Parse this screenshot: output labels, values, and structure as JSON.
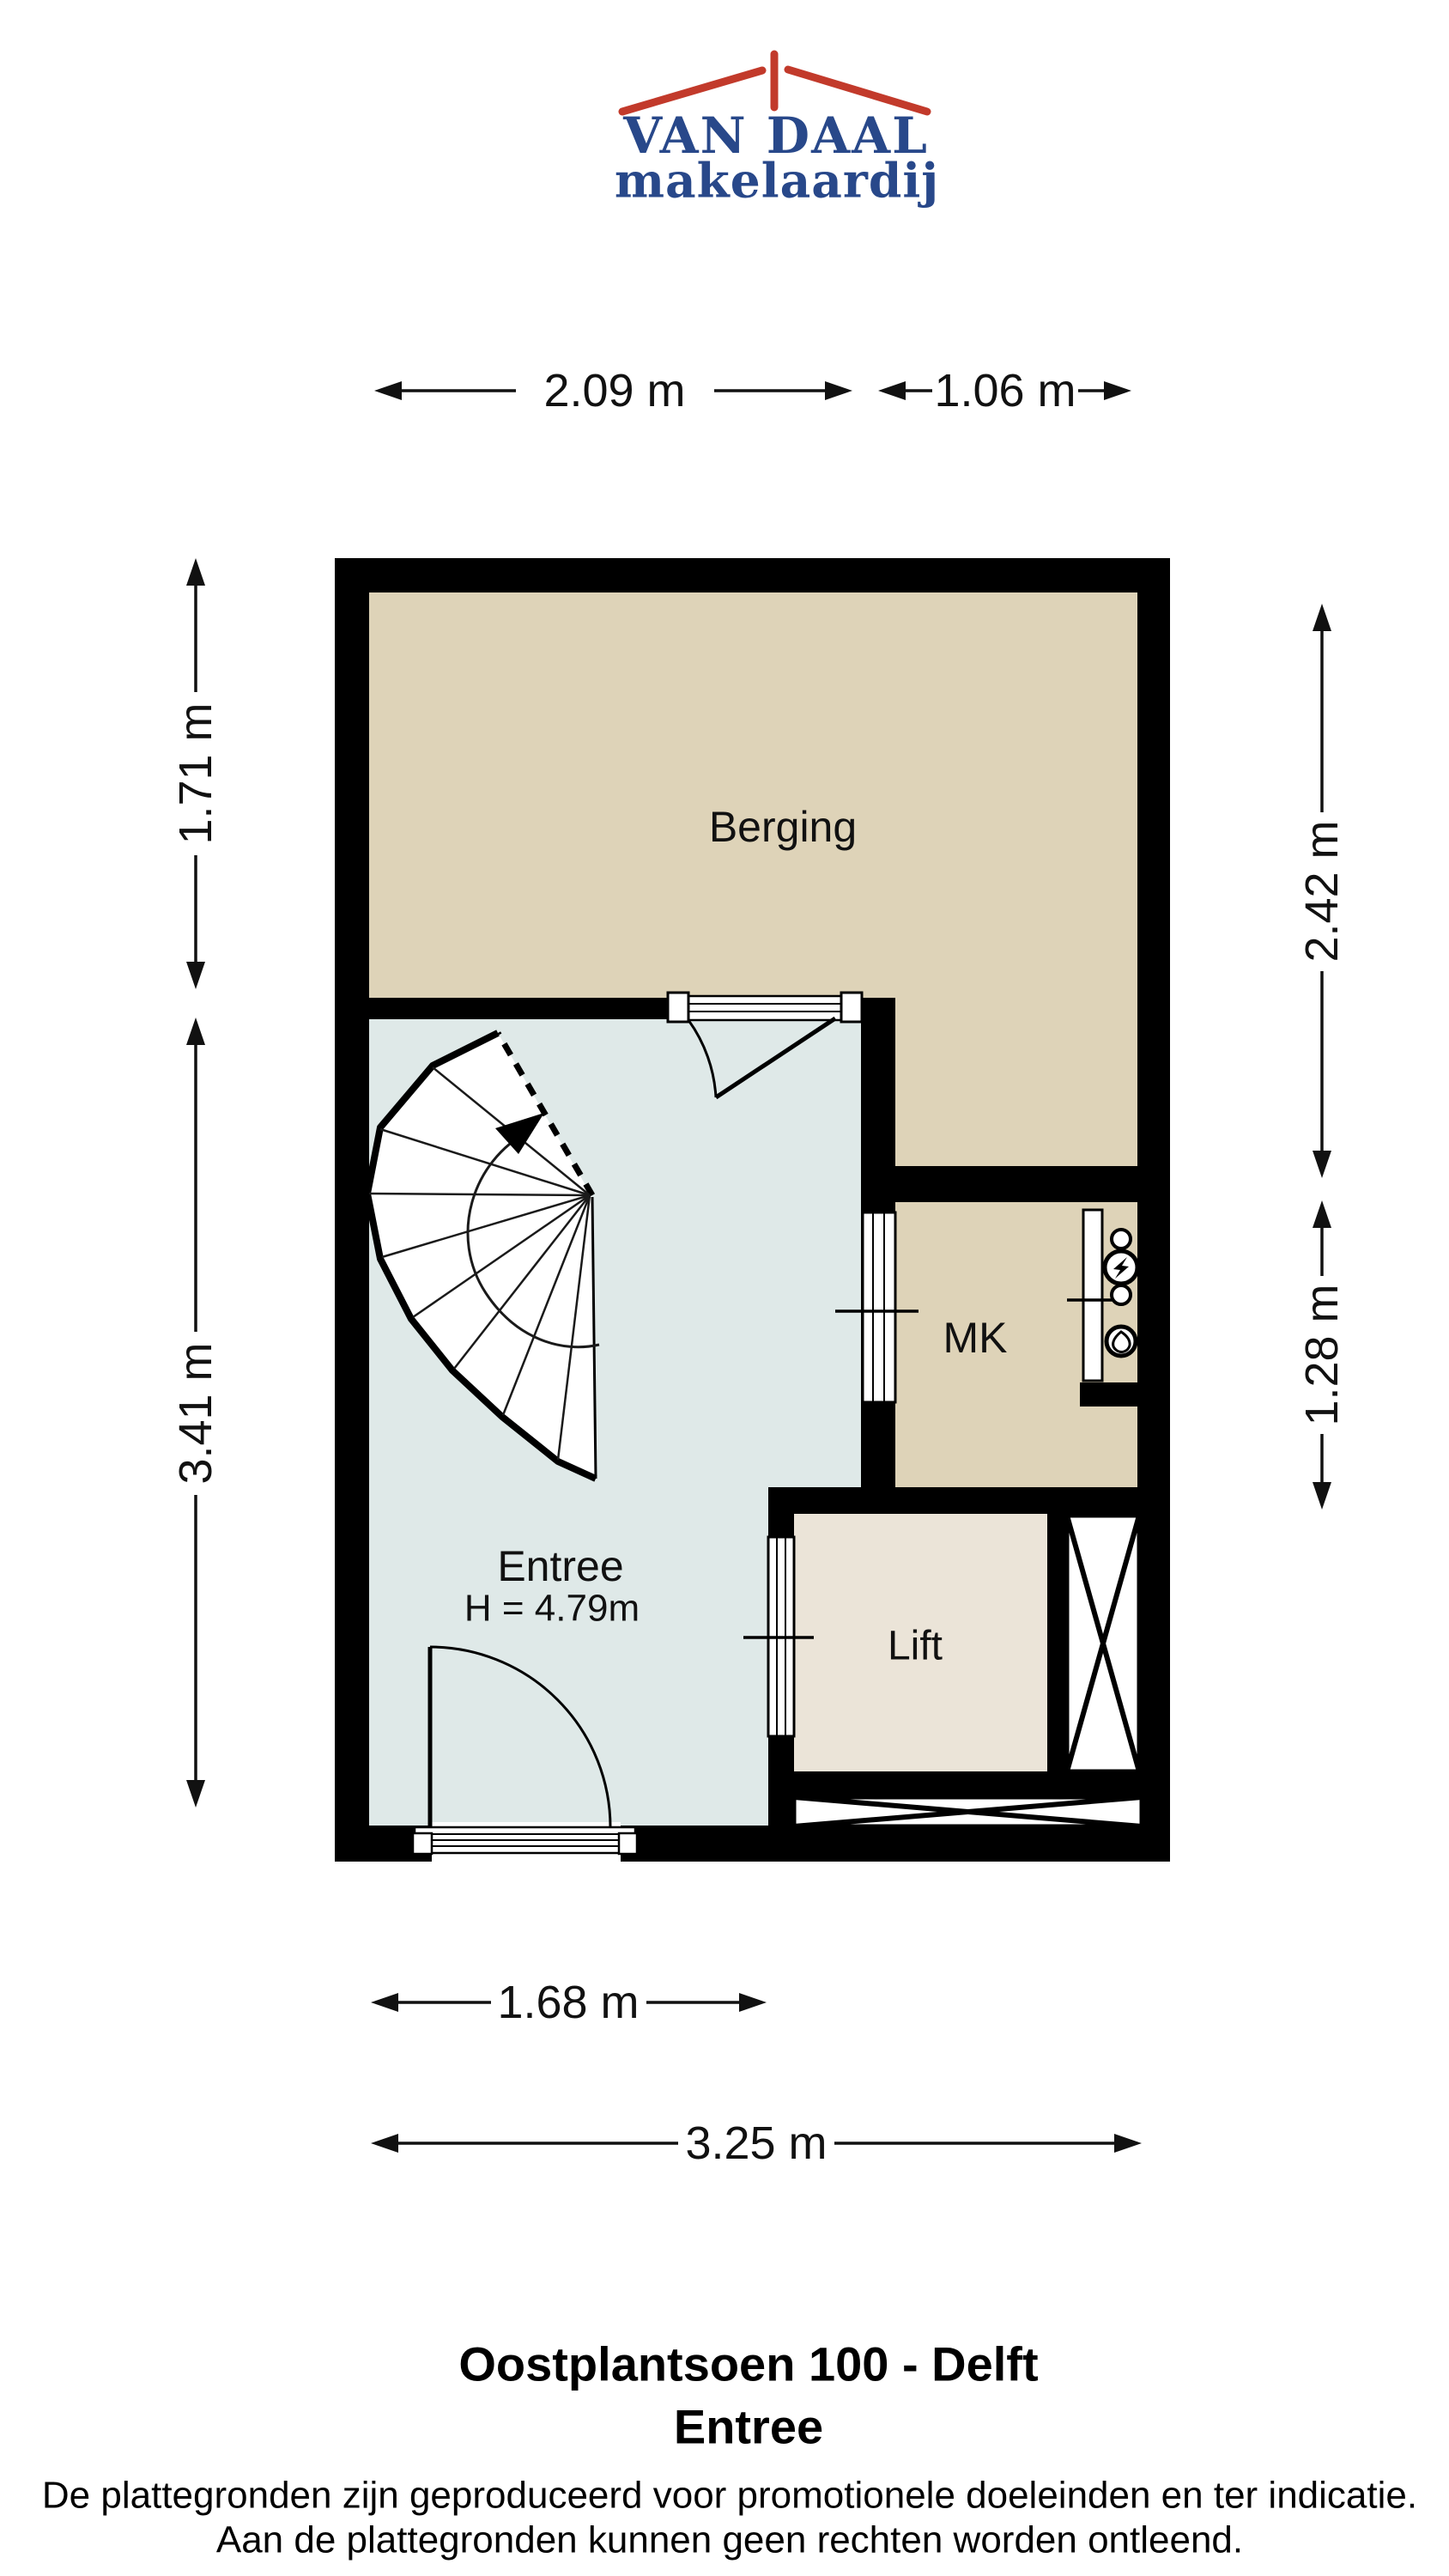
{
  "logo": {
    "brand": "VAN DAAL",
    "tagline": "makelaardij",
    "roof_color": "#c23a2b",
    "text_color": "#28488a"
  },
  "plan": {
    "rooms": {
      "berging": {
        "label": "Berging"
      },
      "mk": {
        "label": "MK"
      },
      "entree": {
        "label": "Entree",
        "ceiling_height": "H = 4.79m"
      },
      "lift": {
        "label": "Lift"
      }
    },
    "colors": {
      "wall": "#000000",
      "berging_floor": "#ded3b8",
      "entree_floor": "#dfe9e8",
      "lift_floor": "#ebe4d8",
      "line": "#111111"
    }
  },
  "dimensions": {
    "top": [
      "2.09 m",
      "1.06 m"
    ],
    "bottom": [
      "1.68 m",
      "3.25 m"
    ],
    "left": [
      "1.71 m",
      "3.41 m"
    ],
    "right": [
      "2.42 m",
      "1.28 m"
    ]
  },
  "footer": {
    "address": "Oostplantsoen 100 - Delft",
    "floor_name": "Entree",
    "disclaimer_line1": "De plattegronden zijn geproduceerd voor promotionele doeleinden en ter indicatie.",
    "disclaimer_line2": "Aan de plattegronden kunnen geen rechten worden ontleend."
  }
}
